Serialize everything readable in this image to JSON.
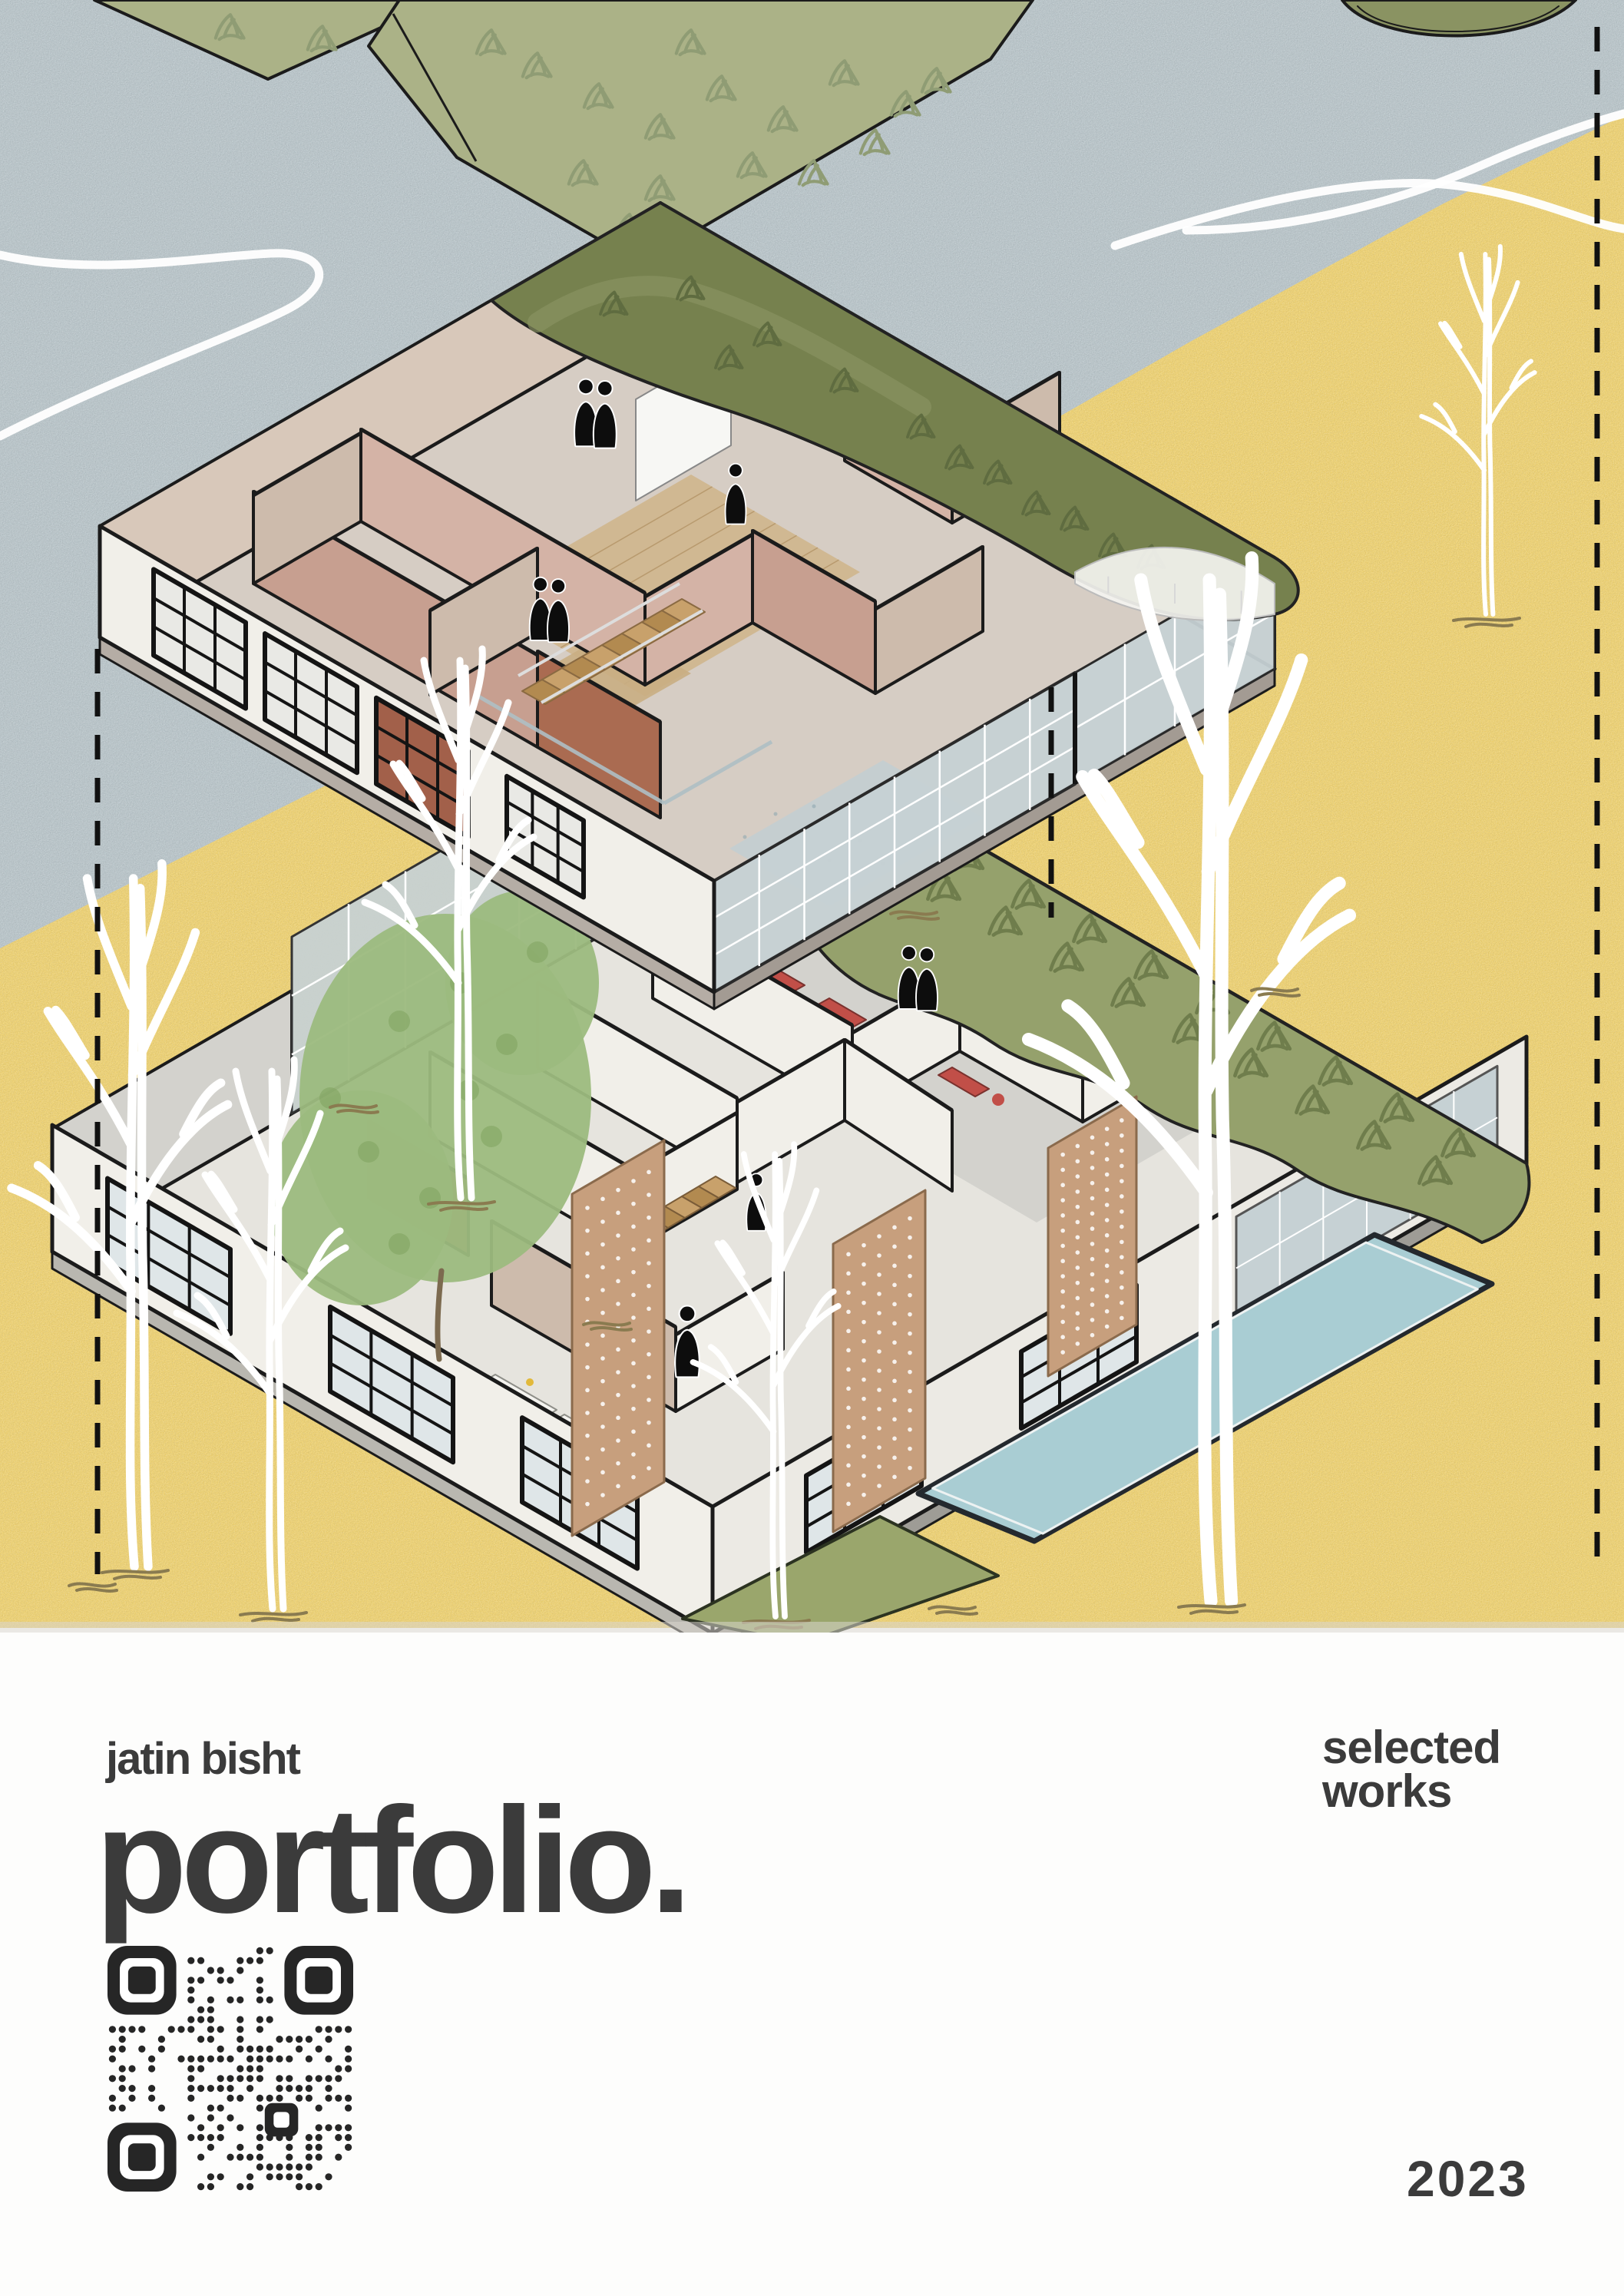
{
  "page": {
    "author": "jatin bisht",
    "title": "portfolio.",
    "subtitle": "selected\nworks",
    "year": "2023"
  },
  "qr": {
    "name": "qr-code",
    "modules": 25,
    "seed": 42,
    "density": 0.47
  },
  "scene": {
    "elements": [
      "water-texture-area",
      "sand-texture-area",
      "grass-plot",
      "grass-plot-large",
      "top-right-green-roof-edge",
      "white-loop-lines",
      "upper-floor-exploded-plate",
      "lower-floor-exploded-plate",
      "green-roof-garden",
      "courtyard-trees",
      "swimming-pool",
      "green-lawn-diamond",
      "perforated-screens",
      "white-tree-lineart",
      "dashed-guidelines",
      "people-silhouettes",
      "qr-code"
    ]
  },
  "colors": {
    "water": "#b6c3c8",
    "sand": "#f0d169",
    "plot_green": "#abb287",
    "tuft_green": "#8f9c74",
    "roof_olive": "#76814e",
    "roof_olive_light": "#8a9362",
    "garden_green": "#95a16c",
    "garden_tuft": "#6f7d4c",
    "lawn_green": "#9aa66c",
    "tree_green": "#9cbb7e",
    "tree_green_dark": "#7fa25e",
    "wall_white": "#f1efe9",
    "wall_gray": "#d3d2cd",
    "wall_tan": "#cdbbac",
    "wall_tan_light": "#d8c8ba",
    "wall_pink": "#c79f90",
    "wall_pink_light": "#d4b3a6",
    "wall_rust": "#aa6b51",
    "glass": "#c6d1d4",
    "glass_light": "#dfe6e8",
    "mullion": "#ffffff",
    "wood_floor": "#cfb68d",
    "wood_stair": "#c8a16b",
    "wood_stair_dark": "#b28a50",
    "slab_top": "#d6cdc4",
    "slab_side": "#b5ada5",
    "floor_gray": "#cfcfca",
    "red_equipment": "#c14f48",
    "pool_water": "#a9cdd3",
    "pool_edge": "#24292e",
    "screen_wood": "#c79f7d",
    "outline": "#1b1b1b",
    "white": "#ffffff",
    "figure": "#0d0d0d",
    "root_brown": "#8a7b50",
    "text": "#3b3b3b",
    "qr": "#262626",
    "paper": "#fdfdfc"
  }
}
